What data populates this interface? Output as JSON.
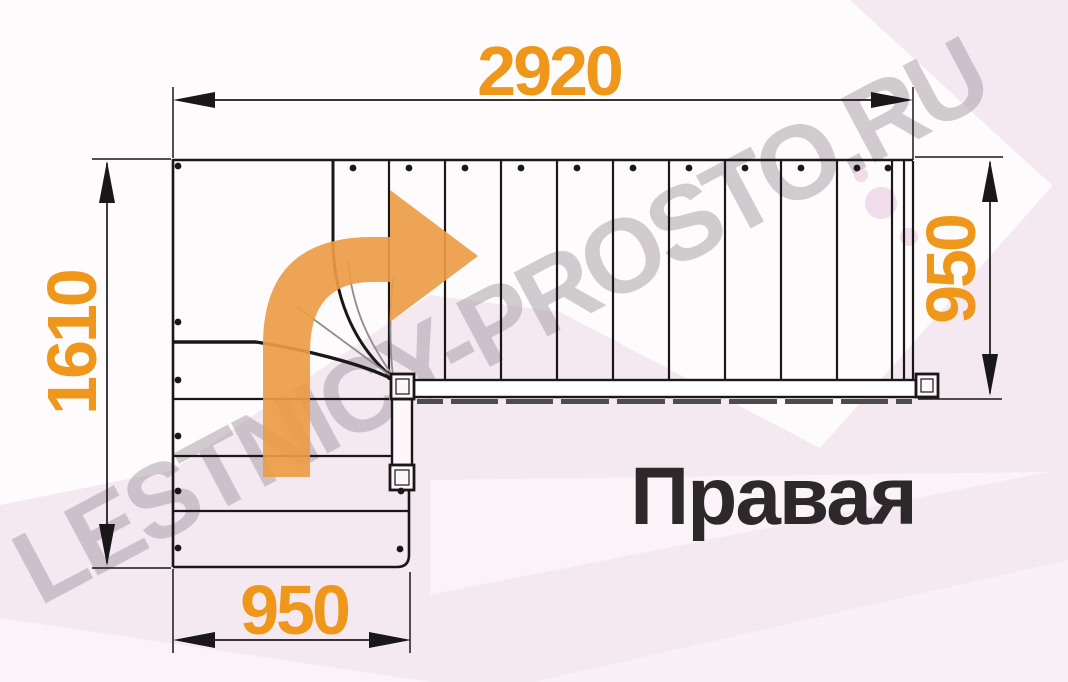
{
  "diagram": {
    "title": "Правая",
    "watermark": "LESTNICY-PROSTO.RU",
    "dimensions": {
      "total_run": "2920",
      "total_depth": "1610",
      "upper_flight_width": "950",
      "lower_flight_width": "950"
    },
    "icons": {
      "direction_arrow": "curved-block-arrow-up-right"
    }
  },
  "colors": {
    "dimension_text": "#ef971b",
    "direction_arrow": "#eb9c45",
    "drawing_line": "#1a1718",
    "gray_line": "#8f8d8e",
    "dark_band": "#4e4b4c",
    "title_text": "#2d292b",
    "watermark_text": "#968a96",
    "background_pink": "#f5e9f1",
    "background_pink_light": "#faf3f8",
    "rail_fill": "#ffffff"
  }
}
